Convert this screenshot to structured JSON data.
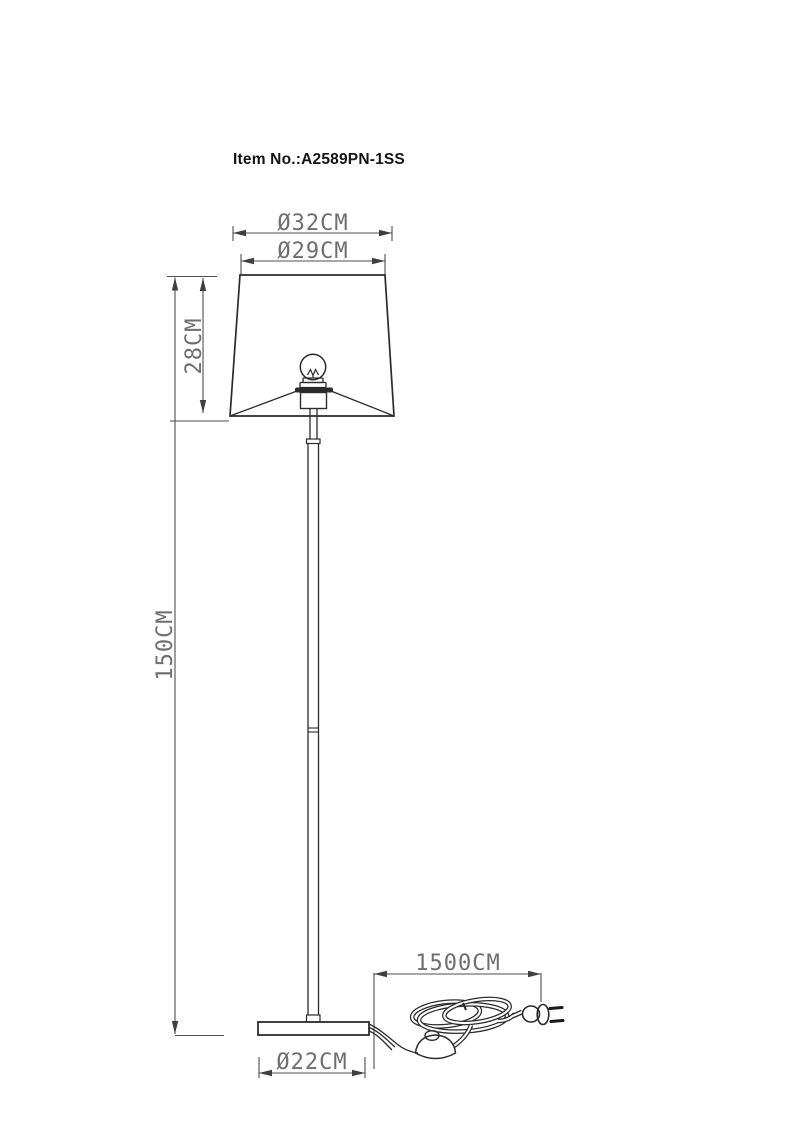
{
  "header": {
    "item_no": "Item No.:A2589PN-1SS"
  },
  "drawing": {
    "product": "floor-lamp-dimension-drawing",
    "dimensions": {
      "shade_bottom_diameter": "Ø32CM",
      "shade_top_diameter": "Ø29CM",
      "shade_height": "28CM",
      "total_height": "150CM",
      "cord_length": "1500CM",
      "base_diameter": "Ø22CM"
    },
    "colors": {
      "background": "#ffffff",
      "outline": "#2b2b2b",
      "dimension_line": "#4f4f4f",
      "dimension_text": "#6e6e6e",
      "item_text": "#141414"
    }
  }
}
